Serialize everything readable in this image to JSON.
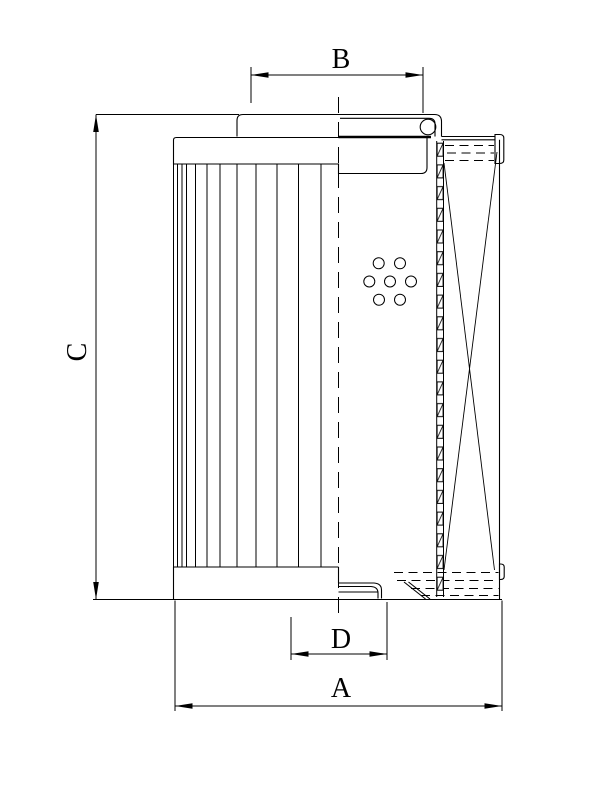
{
  "page": {
    "background_color": "#ffffff",
    "line_color": "#000000"
  },
  "drawing": {
    "kind": "filter-element-cross-section",
    "dimensions": {
      "a": {
        "label": "A"
      },
      "b": {
        "label": "B"
      },
      "c": {
        "label": "C"
      },
      "d": {
        "label": "D"
      }
    }
  }
}
